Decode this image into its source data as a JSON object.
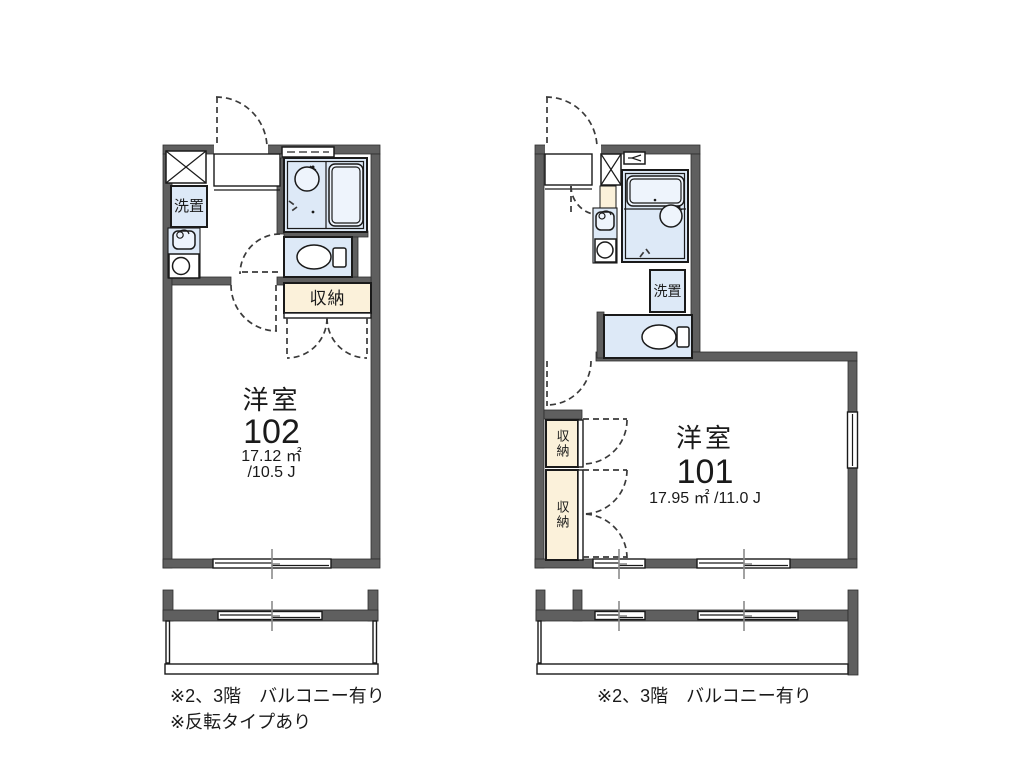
{
  "page": {
    "background": "#ffffff"
  },
  "colors": {
    "wall_gray": "#5f5f5f",
    "fixture_blue": "#dde9f7",
    "storage_cream": "#fbf1da",
    "tick_gray": "#8a8a8a"
  },
  "unit_left": {
    "room_type": "洋室",
    "room_number": "102",
    "area_m2": "17.12 ㎡",
    "area_jo": "/10.5 J",
    "laundry_label": "洗置",
    "storage_label": "収納",
    "notes": [
      "※2、3階　バルコニー有り",
      "※反転タイプあり"
    ]
  },
  "unit_right": {
    "room_type": "洋室",
    "room_number": "101",
    "area": "17.95 ㎡ /11.0 J",
    "laundry_label": "洗置",
    "storage_label_upper": "収納",
    "storage_label_lower": "収納",
    "notes": [
      "※2、3階　バルコニー有り"
    ]
  }
}
